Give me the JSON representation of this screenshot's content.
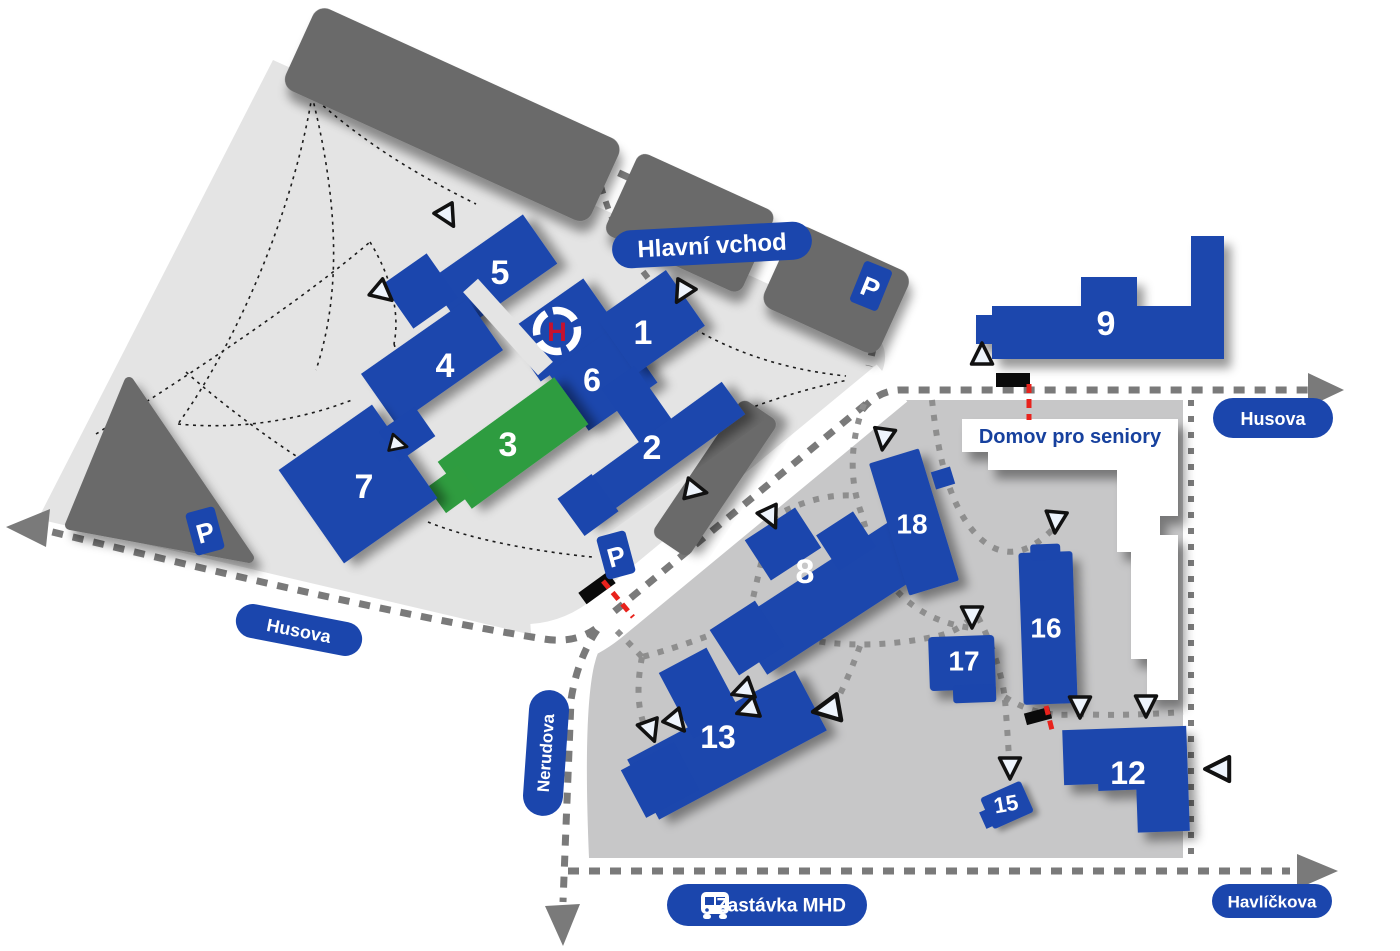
{
  "map": {
    "entrance_label": "Hlavní vchod",
    "seniors_home_label": "Domov pro seniory",
    "bus_stop_label": "Zastávka MHD",
    "streets": {
      "husova": "Husova",
      "nerudova": "Nerudova",
      "havlickova": "Havlíčkova"
    },
    "markers": {
      "parking": "P",
      "helipad": "H"
    },
    "buildings": [
      {
        "label": "1"
      },
      {
        "label": "2"
      },
      {
        "label": "3"
      },
      {
        "label": "4"
      },
      {
        "label": "5"
      },
      {
        "label": "6"
      },
      {
        "label": "7"
      },
      {
        "label": "8"
      },
      {
        "label": "9"
      },
      {
        "label": "12"
      },
      {
        "label": "13"
      },
      {
        "label": "15"
      },
      {
        "label": "16"
      },
      {
        "label": "17"
      },
      {
        "label": "18"
      }
    ],
    "colors": {
      "building_blue": "#1b46ad",
      "building_green": "#2f9c3f",
      "campus_upper": "#e4e4e4",
      "campus_lower": "#c7c7c8",
      "structure_dark": "#6b6b6b",
      "road_dash": "#7a7a7a",
      "path_dot": "#8e8e8e",
      "gate_red": "#e8221c",
      "helipad_red": "#c51230",
      "seniors_home_text": "#17419e"
    }
  }
}
